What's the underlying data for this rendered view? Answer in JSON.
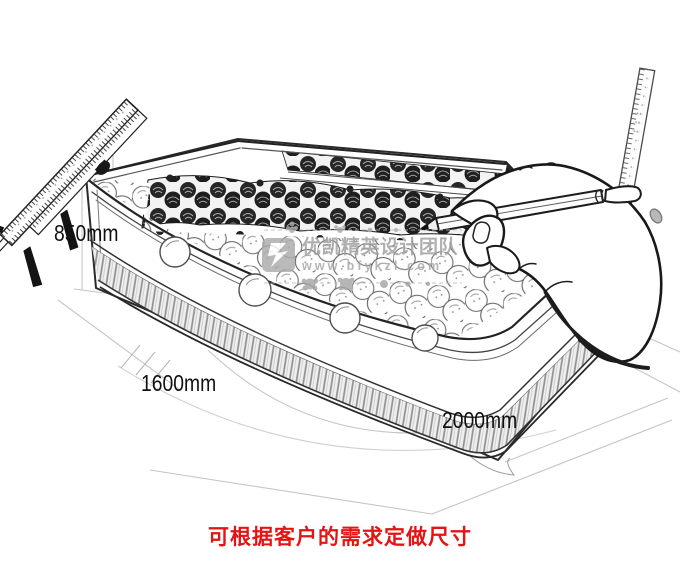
{
  "canvas": {
    "width": 680,
    "height": 578,
    "background": "#ffffff"
  },
  "illustration": {
    "subject": "hand-drawn-produce-display-cabinet-sketch",
    "elements": [
      "vernier-caliper",
      "steel-ruler",
      "hand-holding-pencil",
      "display-cabinet-with-produce"
    ]
  },
  "dimensions": {
    "height": "850mm",
    "depth": "1600mm",
    "length": "2000mm"
  },
  "watermark": {
    "brand": "优凯精英设计团队",
    "url": "www.bfykzl.com",
    "color": "#a0a0a0"
  },
  "caption": {
    "text": "可根据客户的需求定做尺寸",
    "color": "#e41414"
  },
  "colors": {
    "sketch_line": "#1c1c1c",
    "guide_line": "#c6c6c6",
    "hatch_gray": "#8f8f8f",
    "produce_dark": "#212121"
  }
}
